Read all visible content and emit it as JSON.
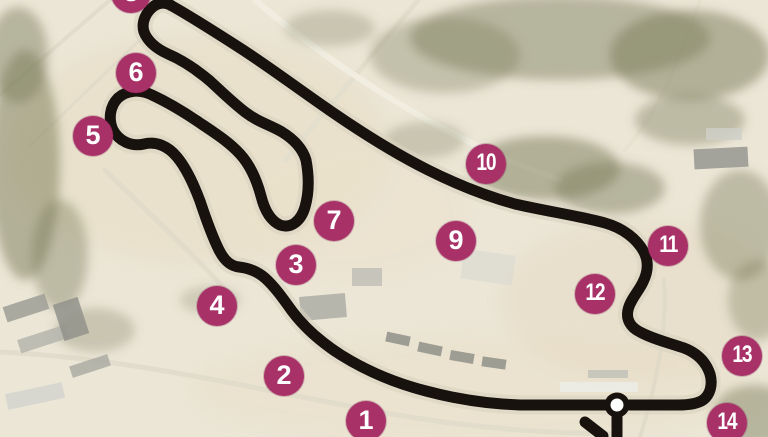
{
  "map": {
    "title": "race-circuit-satellite-map",
    "colors": {
      "badge": "#a83168",
      "badge_text": "#ffffff",
      "track": "#17120d",
      "track_underlay": "#d9d2bf",
      "marker_fill": "#ffffff",
      "background": "#ece6d7"
    },
    "start_finish_marker": {
      "x": 617,
      "y": 405
    },
    "turn_badges": [
      {
        "label": "1",
        "x": 366,
        "y": 421
      },
      {
        "label": "2",
        "x": 284,
        "y": 376
      },
      {
        "label": "3",
        "x": 296,
        "y": 265
      },
      {
        "label": "4",
        "x": 217,
        "y": 306
      },
      {
        "label": "5",
        "x": 93,
        "y": 136
      },
      {
        "label": "6",
        "x": 136,
        "y": 73
      },
      {
        "label": "7",
        "x": 334,
        "y": 221
      },
      {
        "label": "8",
        "x": 131,
        "y": -7
      },
      {
        "label": "9",
        "x": 456,
        "y": 241
      },
      {
        "label": "10",
        "x": 486,
        "y": 164
      },
      {
        "label": "11",
        "x": 668,
        "y": 246
      },
      {
        "label": "12",
        "x": 595,
        "y": 294
      },
      {
        "label": "13",
        "x": 742,
        "y": 356
      },
      {
        "label": "14",
        "x": 727,
        "y": 423
      }
    ]
  }
}
